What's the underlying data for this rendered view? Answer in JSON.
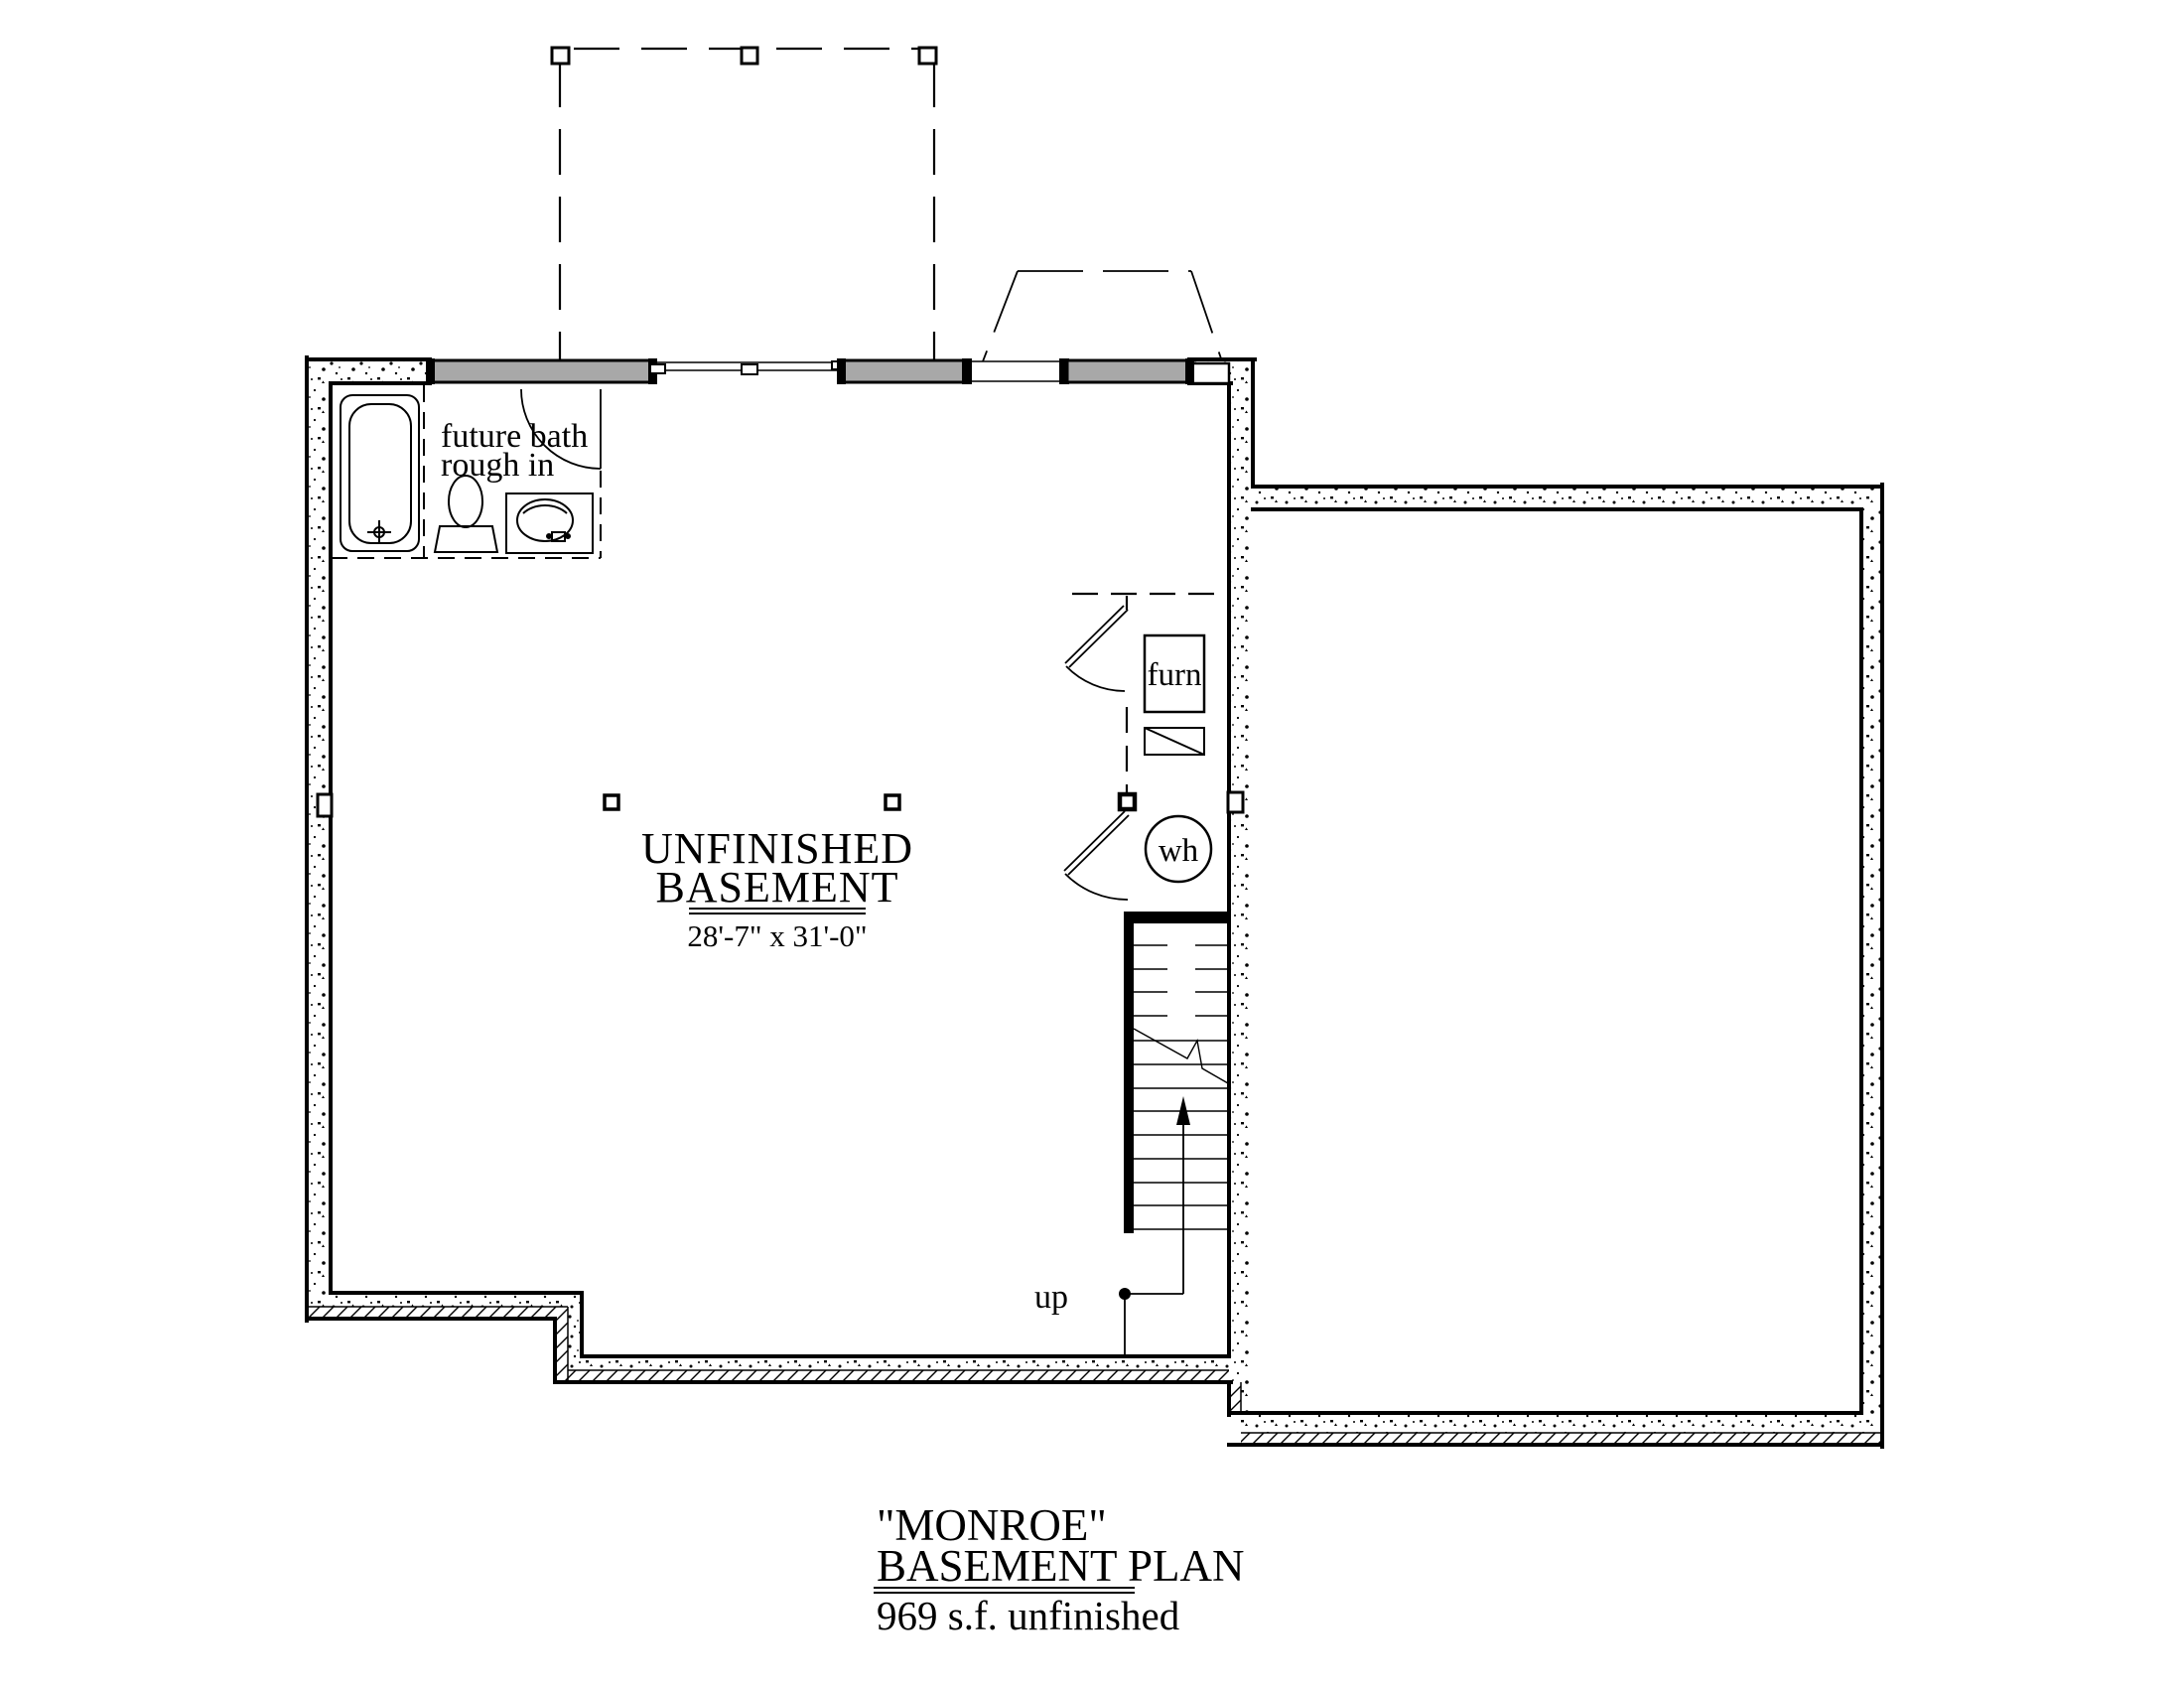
{
  "document": {
    "kind": "basement floor plan drawing",
    "background": "#ffffff",
    "line_color": "#000000",
    "window_fill": "#a8a8a8"
  },
  "plan": {
    "main_room": {
      "name_line1": "UNFINISHED",
      "name_line2": "BASEMENT",
      "dimensions": "28'-7\" x 31'-0\""
    },
    "labels": {
      "future_bath_line1": "future bath",
      "future_bath_line2": "rough in",
      "furnace": "furn",
      "water_heater": "wh",
      "stairs_up": "up"
    }
  },
  "title_block": {
    "plan_name": "\"MONROE\"",
    "plan_type": "BASEMENT PLAN",
    "area_note": "969 s.f. unfinished"
  }
}
